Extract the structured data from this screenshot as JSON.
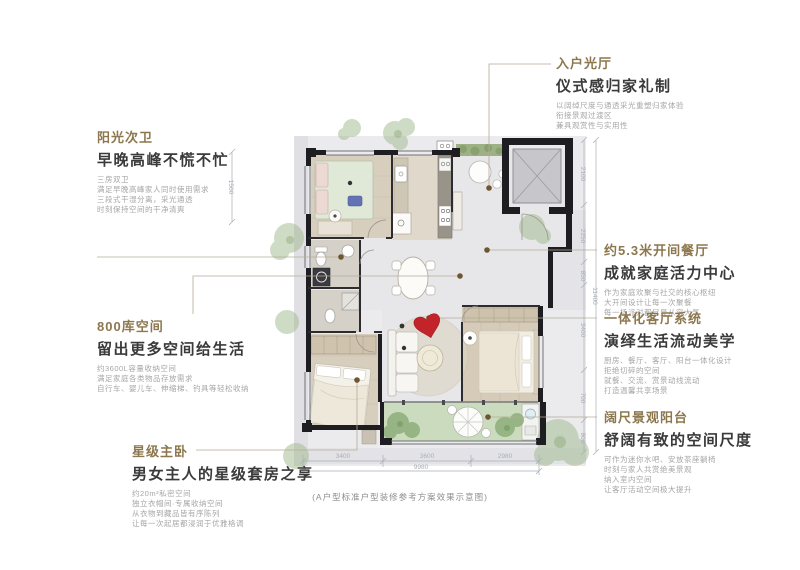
{
  "caption": "(A户型标准户型装修参考方案效果示意图)",
  "annotations": {
    "entry_hall": {
      "title": "入户光厅",
      "subtitle": "仪式感归家礼制",
      "lines": [
        "以阔绰尺度与通透采光重塑归家体验",
        "衔接景观过渡区",
        "兼具观赏性与实用性"
      ]
    },
    "sun_bathroom": {
      "title": "阳光次卫",
      "subtitle": "早晚高峰不慌不忙",
      "lines": [
        "三房双卫",
        "满足早晚高峰家人同时使用需求",
        "三段式干湿分离，采光通透",
        "时刻保持空间的干净清爽"
      ]
    },
    "storage": {
      "title": "800库空间",
      "subtitle": "留出更多空间给生活",
      "lines": [
        "约3600L容量收纳空间",
        "满足家庭各类物品存放需求",
        "自行车、婴儿车、伸缩梯、钓具等轻松收纳"
      ]
    },
    "master_bedroom": {
      "title": "星级主卧",
      "subtitle": "男女主人的星级套房之享",
      "lines": [
        "约20m²私密空间",
        "独立衣帽间·专属收纳空间",
        "从衣物到藏品皆有序陈列",
        "让每一次起居都浸润于优雅格调"
      ]
    },
    "dining": {
      "title": "约5.3米开间餐厅",
      "subtitle": "成就家庭活力中心",
      "lines": [
        "作为家庭欢聚与社交的核心枢纽",
        "大开间设计让每一次聚餐",
        "每一场派对都尽显从容大气"
      ]
    },
    "living": {
      "title": "一体化客厅系统",
      "subtitle": "演绎生活流动美学",
      "lines": [
        "厨房、餐厅、客厅、阳台一体化设计",
        "拒绝切碎的空间",
        "就餐、交流、赏景动线流动",
        "打造温馨共享场景"
      ]
    },
    "balcony": {
      "title": "阔尺景观阳台",
      "subtitle": "舒阔有致的空间尺度",
      "lines": [
        "可作为迷你水吧、安放茶座躺椅",
        "时刻与家人共赏绝美景观",
        "纳入室内空间",
        "让客厅活动空间极大提升"
      ]
    }
  },
  "dimensions": {
    "bottom_segments": [
      "3400",
      "3600",
      "2980"
    ],
    "bottom_total": "9980",
    "right_segments": [
      "2100",
      "2250",
      "850",
      "3400",
      "700",
      "800"
    ],
    "right_total": "11400",
    "left_segment": "1500"
  },
  "colors": {
    "accent_gold": "#8c774e",
    "heart_red": "#c3242a",
    "balcony_green": "#cadcbd",
    "tree_green": "#9fb88c",
    "wall_black": "#1e1e22"
  }
}
